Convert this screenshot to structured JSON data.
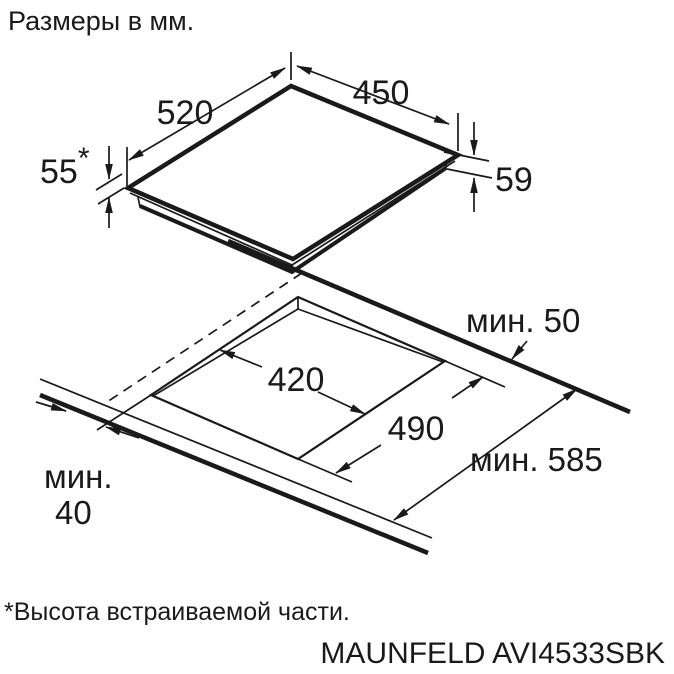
{
  "page": {
    "title": "Размеры в мм.",
    "footnote": "*Высота встраиваемой части.",
    "model": "MAUNFELD AVI4533SBK"
  },
  "dimensions": {
    "top_width": "450",
    "top_depth": "520",
    "height_left": "55",
    "height_left_note": "*",
    "height_right": "59",
    "cutout_width": "420",
    "cutout_depth": "490",
    "clearance_back": "мин. 50",
    "clearance_total": "мин. 585",
    "clearance_front_word": "мин.",
    "clearance_front_value": "40"
  },
  "colors": {
    "line": "#1a1a1a",
    "background": "#ffffff"
  }
}
